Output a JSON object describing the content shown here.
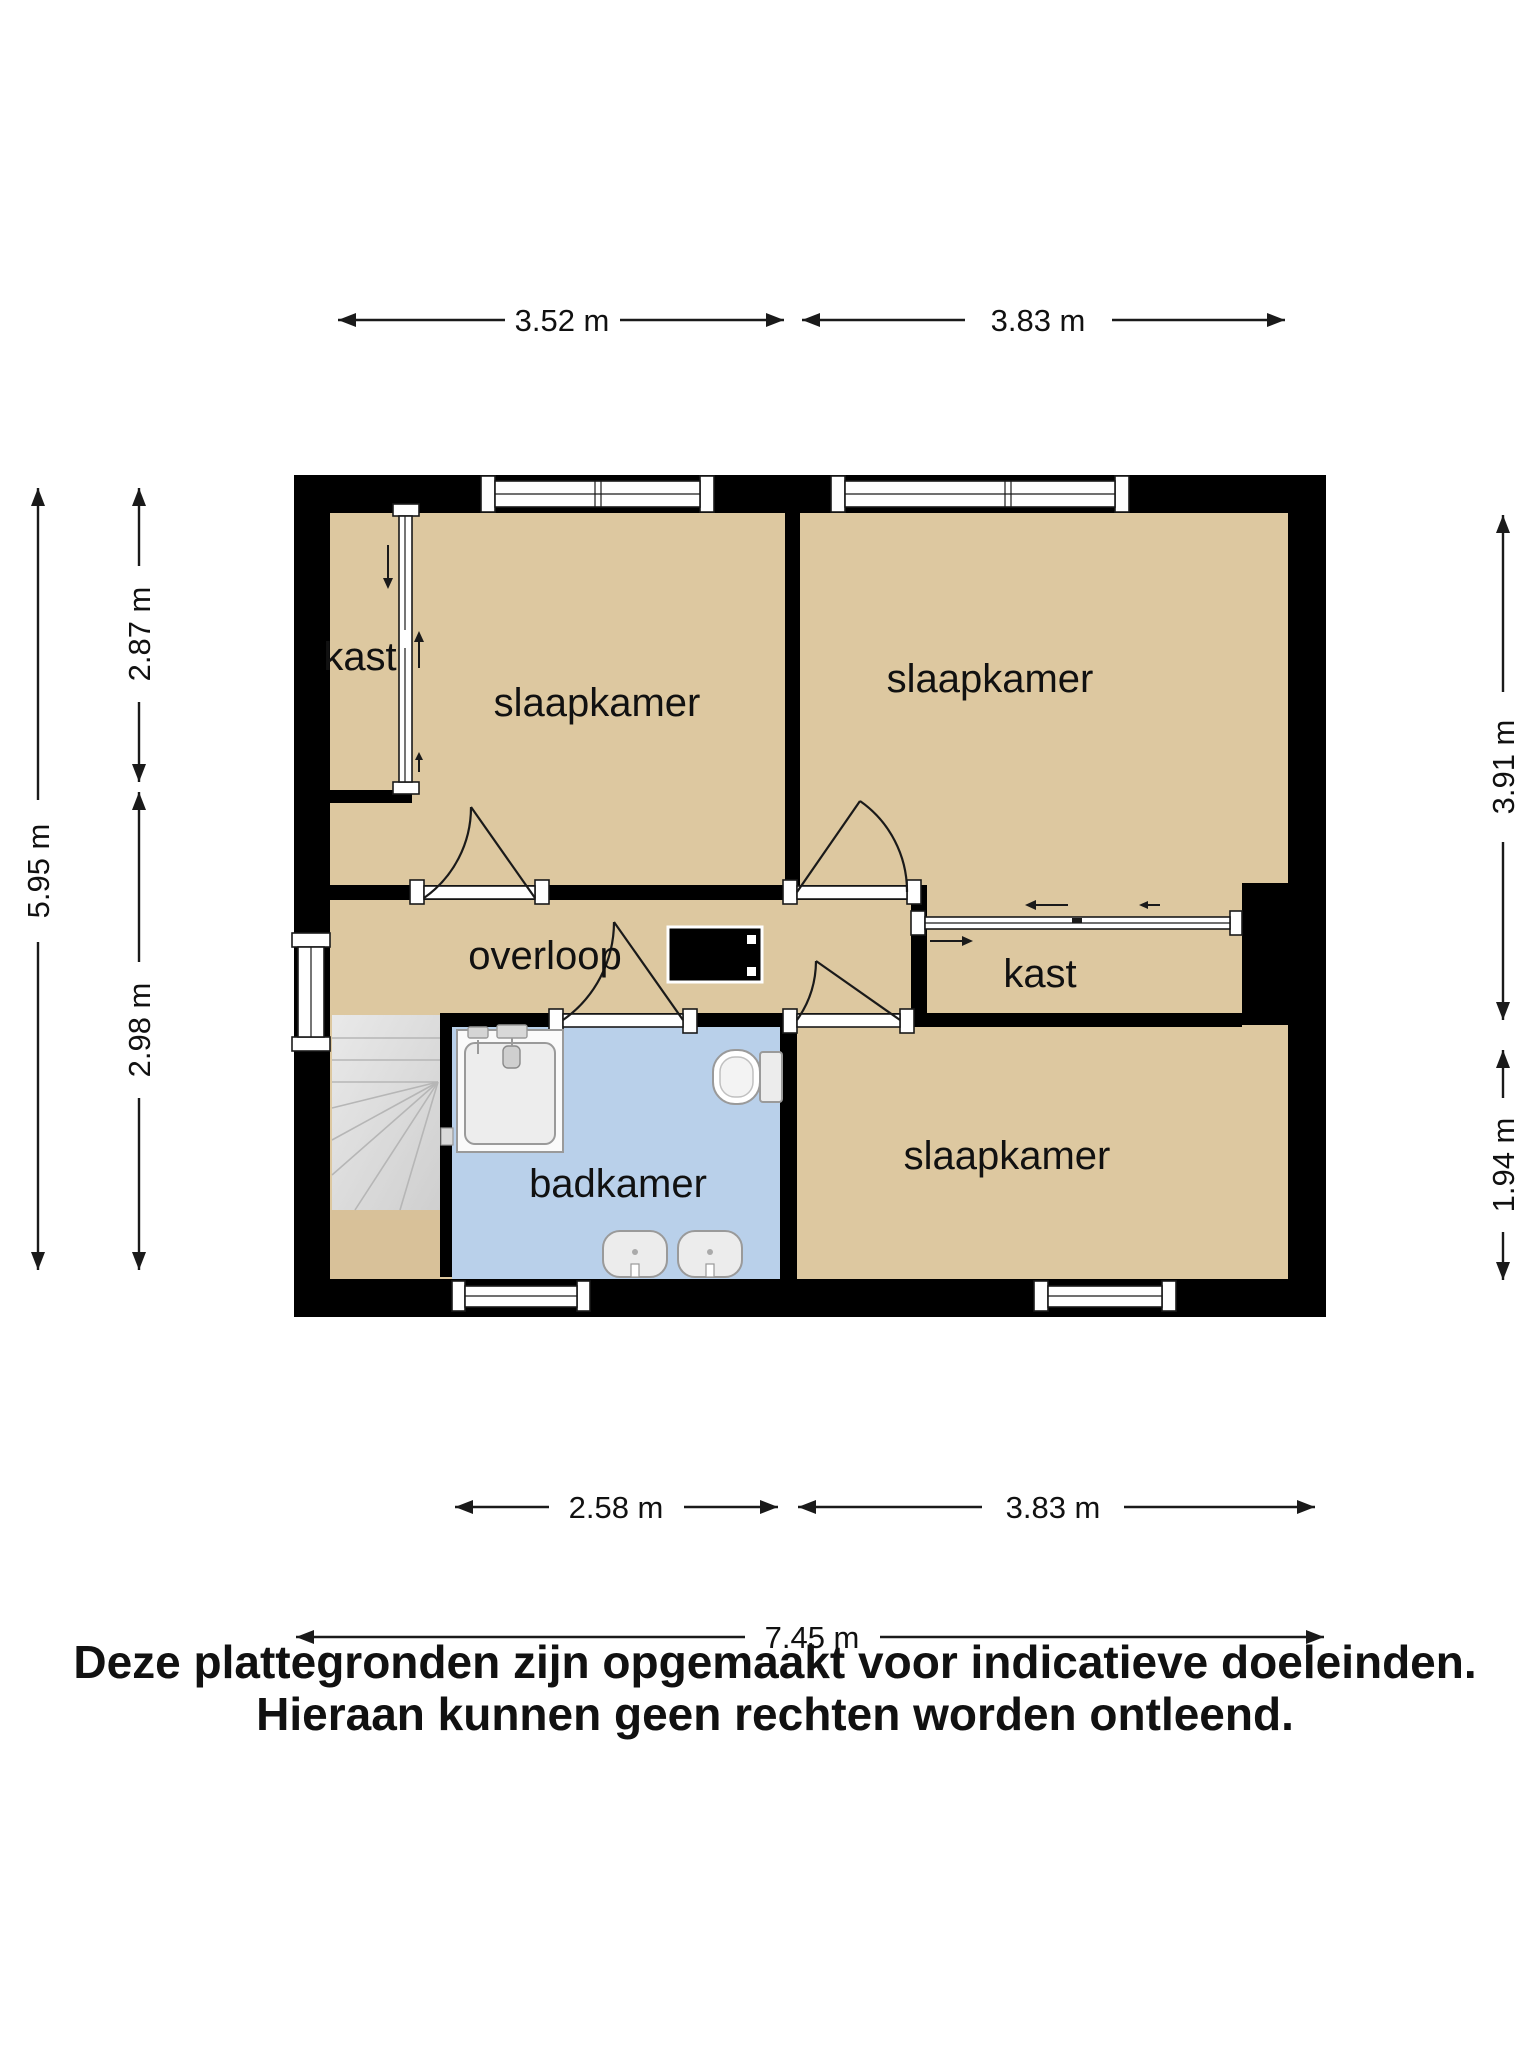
{
  "floor_plan": {
    "title_hint": "second floor plan",
    "rooms": [
      {
        "id": "kast-top-left",
        "label": "kast"
      },
      {
        "id": "slaapkamer-top-left",
        "label": "slaapkamer"
      },
      {
        "id": "slaapkamer-top-right",
        "label": "slaapkamer"
      },
      {
        "id": "overloop",
        "label": "overloop"
      },
      {
        "id": "kast-right",
        "label": "kast"
      },
      {
        "id": "badkamer",
        "label": "badkamer"
      },
      {
        "id": "slaapkamer-bottom-right",
        "label": "slaapkamer"
      }
    ],
    "dimensions": {
      "top": [
        {
          "label": "3.52 m"
        },
        {
          "label": "3.83 m"
        }
      ],
      "bottom_inner": [
        {
          "label": "2.58 m"
        },
        {
          "label": "3.83 m"
        }
      ],
      "bottom_total": {
        "label": "7.45 m"
      },
      "left_inner": [
        {
          "label": "2.87 m"
        },
        {
          "label": "2.98 m"
        }
      ],
      "left_total": {
        "label": "5.95 m"
      },
      "right": [
        {
          "label": "3.91 m"
        },
        {
          "label": "1.94 m"
        }
      ]
    },
    "disclaimer": {
      "line1": "Deze plattegronden zijn opgemaakt voor indicatieve doeleinden.",
      "line2": "Hieraan kunnen geen rechten worden ontleend."
    },
    "colors": {
      "wall": "#000000",
      "room_floor": "#DDC8A0",
      "under_stairs_floor": "#D8C199",
      "bathroom_floor": "#B9D0EA",
      "stairs": "#E2E2E2",
      "fixture_fill": "#ECECEC",
      "text": "#111111"
    },
    "icons": {
      "dimension_arrow": "filled-triangle",
      "sliding_door_arrow": "small-line-arrow",
      "door_swing": "quarter-arc"
    }
  }
}
